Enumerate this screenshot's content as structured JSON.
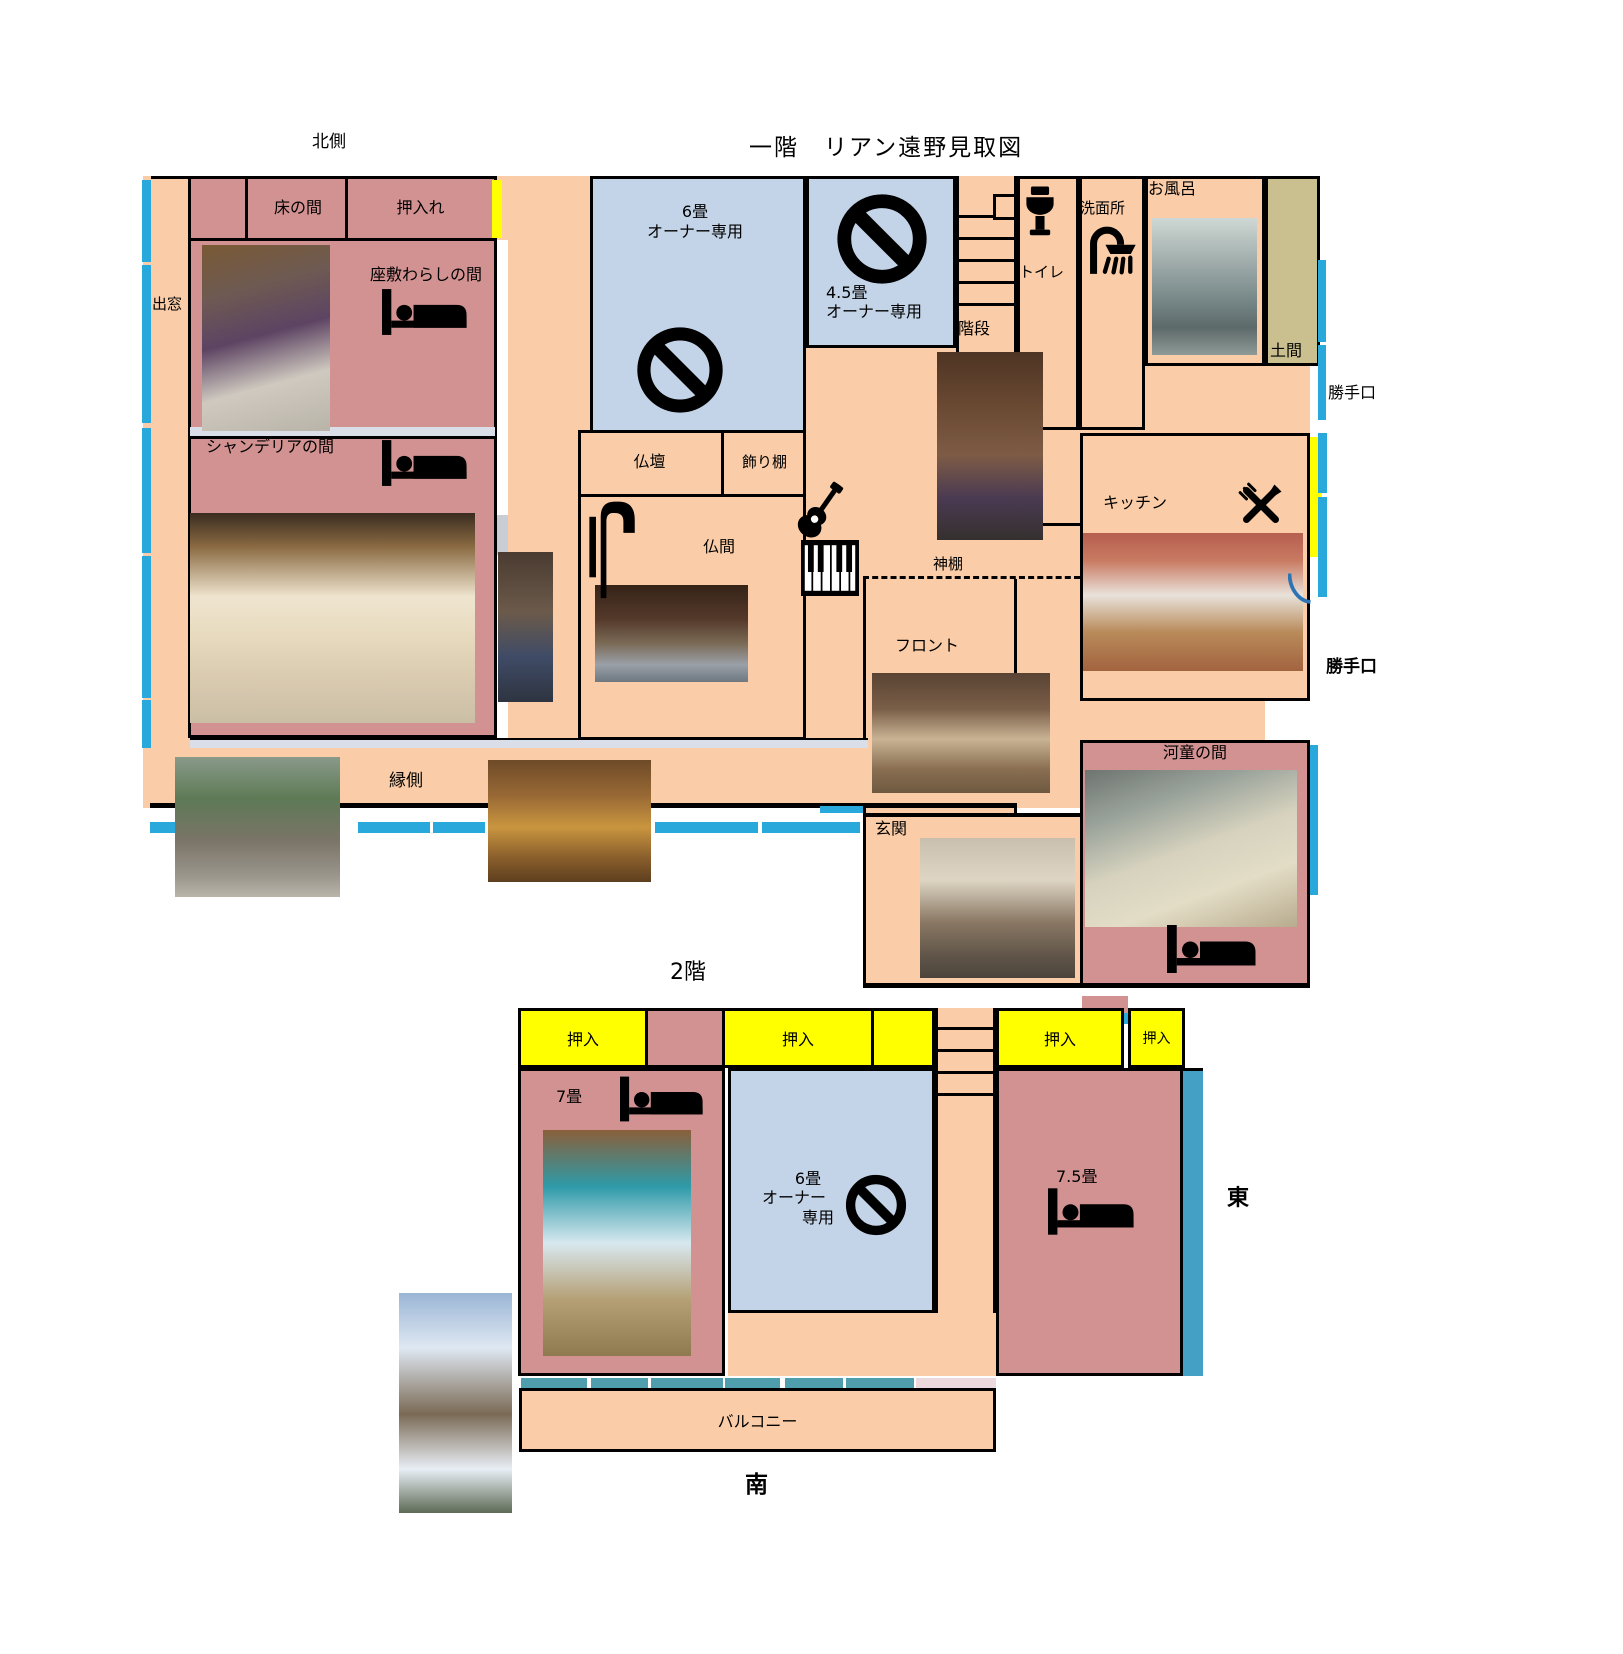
{
  "title": "一階　リアン遠野見取図",
  "compass": {
    "north_side": "北側",
    "south": "南",
    "east": "東"
  },
  "floor1": {
    "rooms": {
      "tokonoma": "床の間",
      "oshiire": "押入れ",
      "zashiki_warashi": "座敷わらしの間",
      "demado": "出窓",
      "chandelier": "シャンデリアの間",
      "engawa": "縁側",
      "butsudan": "仏壇",
      "kazaridana": "飾り棚",
      "butsuma": "仏間",
      "owner6_line1": "6畳",
      "owner6_line2": "オーナー専用",
      "owner45_line1": "4.5畳",
      "owner45_line2": "オーナー専用",
      "kaidan": "階段",
      "toire": "トイレ",
      "senmenjo": "洗面所",
      "ofuro": "お風呂",
      "doma": "土間",
      "katteguchi_north": "勝手口",
      "kitchen": "キッチン",
      "katteguchi_east": "勝手口",
      "kamidana": "神棚",
      "front": "フロント",
      "genkan": "玄関",
      "kappa": "河童の間"
    }
  },
  "floor2": {
    "heading": "2階",
    "rooms": {
      "closet": "押入",
      "jo7": "7畳",
      "owner6_line1": "6畳",
      "owner6_line2": "オーナー",
      "owner6_line3": "専用",
      "jo75": "7.5畳",
      "balcony": "バルコニー"
    }
  },
  "icons": {
    "bed-icon": "bed silhouette",
    "no-entry-icon": "prohibition circle with slash",
    "toilet-icon": "toilet",
    "shower-icon": "shower head with spray",
    "crossed-utensils-icon": "crossed fork and knife",
    "guitar-icon": "guitar",
    "piano-icon": "piano keyboard",
    "armchair-icon": "high-back chair",
    "door-arc-icon": "door swing arc"
  },
  "photos": [
    {
      "id": "photo-zashiki-warashi-room",
      "depicts": "tatami room with purple walls and round lamp"
    },
    {
      "id": "photo-chandelier-room",
      "depicts": "Japanese parlor with chandelier, table and white armchairs"
    },
    {
      "id": "photo-kimono-children",
      "depicts": "children in kimono standing in dark corridor"
    },
    {
      "id": "photo-butsuma-children",
      "depicts": "children sitting in a row on veranda step"
    },
    {
      "id": "photo-staircase-children",
      "depicts": "children posing on wooden staircase"
    },
    {
      "id": "photo-bath",
      "depicts": "tiled bathroom with stainless tub"
    },
    {
      "id": "photo-kitchen",
      "depicts": "kitchen with dining table and red curtain"
    },
    {
      "id": "photo-front-desk",
      "depicts": "reception counter hallway"
    },
    {
      "id": "photo-genkan",
      "depicts": "two hosts standing at entrance"
    },
    {
      "id": "photo-kappa-room",
      "depicts": "futon bedding laid out on floor"
    },
    {
      "id": "photo-engawa-exterior",
      "depicts": "two people sitting on outside veranda edge"
    },
    {
      "id": "photo-engawa-corridor",
      "depicts": "sunlit wooden veranda corridor"
    },
    {
      "id": "photo-7jo-room",
      "depicts": "tatami room with blue wall and bright window"
    },
    {
      "id": "photo-balcony-winter",
      "depicts": "snowy balcony with railing and bench"
    }
  ],
  "colors": {
    "corridor_peach": "#FACDA8",
    "guest_room_pink": "#D29292",
    "owner_room_blue": "#C4D4E8",
    "closet_yellow": "#FFFF00",
    "doma_olive": "#C9BF8F",
    "window_cyan": "#29A8DC",
    "window_teal": "#4E9EAE",
    "window_steel_blue": "#44A0C4",
    "hall_strip_gray": "#D9DEE8",
    "balcony_edge_pink": "#EBD9DE",
    "wall_black": "#000000"
  }
}
